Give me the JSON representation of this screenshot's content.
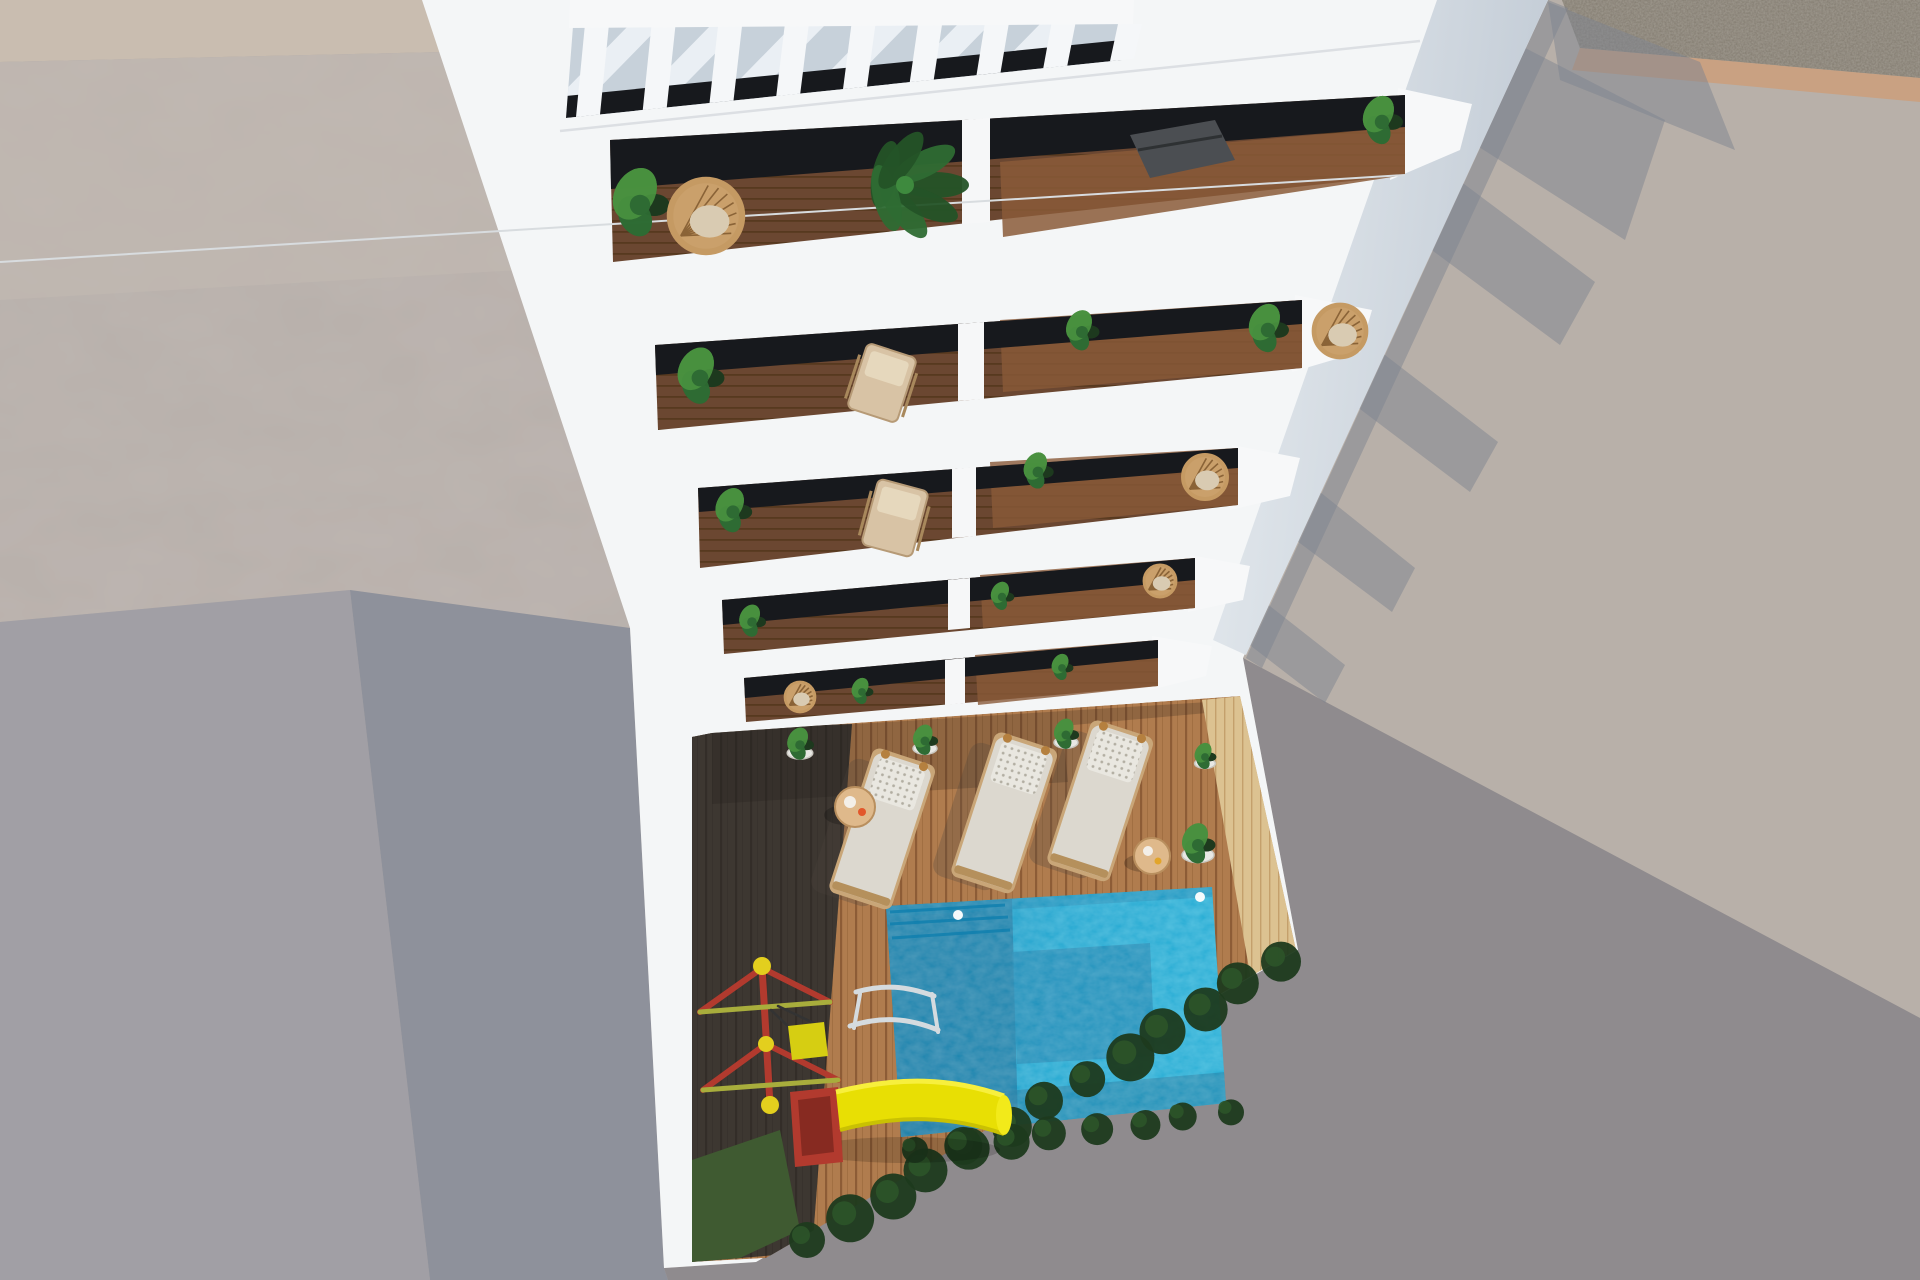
{
  "scene": {
    "title": "aerial-render-apartment-building-pool-courtyard",
    "description": "Top-down 3D architectural render: white apartment tower with pergola roof and five balcony rows over a courtyard with swimming pool, wood deck, sun loungers and children's playground",
    "colors": {
      "ground_base": "#b4aba4",
      "ground_lit": "#b8b0a9",
      "ground_shadow": "#8f8b8e",
      "concrete_left": "#b8b0ab",
      "concrete_light": "#c2bab3",
      "tan_strip": "#c9bdb0",
      "plane_a": "#a19fa5",
      "plane_b": "#8e919b",
      "gravel": "#a09a90",
      "gravel_border": "#c9a182",
      "building": "#f4f6f7",
      "building_face": "#cfd8e0",
      "pergola_floor": "#c7d1da",
      "glass": "#17191d",
      "balcony_wood": "#6b4731",
      "balcony_wood_lit": "#8a5a38",
      "deck_lit": "#b07c4e",
      "deck_line": "#8d5c36",
      "deck_shadow": "#2e2a26",
      "pool_bright": "#1aa6d0",
      "pool_mid": "#1187b3",
      "pool_dark": "#0b5c86",
      "pool_deep": "#0a5278",
      "sand": "#dcc291",
      "sand_line": "#c4a06c",
      "lounger": "#dcd8cf",
      "pillow": "#edece6",
      "knob": "#b5803f",
      "slide_yellow": "#e8df04",
      "play_red": "#b23a2e",
      "play_red_dark": "#872a21",
      "cap_yellow": "#e3cf1e",
      "bar_green": "#a8ad3c",
      "plant_dark": "#1d3a1e",
      "plant_mid": "#2e6b33",
      "plant_light": "#49903f",
      "wicker": "#c59a63",
      "wicker_dark": "#8a6337",
      "grass": "#3f5a31",
      "wall_inner_dark": "#5f5850",
      "ladder": "#d5dbdf",
      "spike_shadow": "#7d8390",
      "chair_beige": "#d8c3a5",
      "dark_lounger": "#4b4e52",
      "table_wood": "#dfb98b"
    },
    "counts": {
      "balcony_rows": 5,
      "pergola_slats": 8,
      "sun_loungers": 3,
      "side_tables": 2,
      "potted_plants": 5,
      "pool_lights": 2
    },
    "pergola": {
      "slat_count": 8,
      "stripe_count": 6
    },
    "loungers": [
      {
        "x": 902,
        "y": 768,
        "angle": 18
      },
      {
        "x": 1024,
        "y": 752,
        "angle": 18
      },
      {
        "x": 1120,
        "y": 740,
        "angle": 18
      }
    ],
    "pots": [
      {
        "x": 800,
        "y": 745,
        "r": 16
      },
      {
        "x": 925,
        "y": 741,
        "r": 15
      },
      {
        "x": 1066,
        "y": 735,
        "r": 15
      },
      {
        "x": 1205,
        "y": 757,
        "r": 13
      },
      {
        "x": 1198,
        "y": 845,
        "r": 20
      }
    ],
    "shadow_spikes": [
      "1500,35 1665,120 1625,240 1468,140",
      "1548,2 1700,62 1735,150 1560,80",
      "1452,175 1595,282 1560,345 1425,245",
      "1372,345 1498,442 1470,492 1348,400",
      "1305,480 1415,568 1392,612 1285,532",
      "1252,592 1345,665 1325,703 1238,636",
      "1548,0 1568,8 1262,668 1246,658"
    ],
    "shrub_strip": {
      "x1": 812,
      "y1": 1242,
      "x2": 1282,
      "y2": 962,
      "n": 13
    },
    "shrub_strip2": {
      "x1": 920,
      "y1": 1152,
      "x2": 1230,
      "y2": 1112,
      "n": 8
    },
    "balcony_plants": [
      [
        640,
        205,
        34
      ],
      [
        1382,
        122,
        24
      ],
      [
        700,
        378,
        28
      ],
      [
        1082,
        332,
        20
      ],
      [
        733,
        512,
        22
      ],
      [
        1038,
        472,
        18
      ],
      [
        752,
        622,
        16
      ],
      [
        1002,
        597,
        14
      ],
      [
        862,
        692,
        13
      ],
      [
        1062,
        668,
        13
      ],
      [
        1268,
        330,
        24
      ]
    ],
    "wicker_chairs": [
      [
        706,
        216,
        36
      ],
      [
        1340,
        331,
        26
      ],
      [
        1205,
        477,
        22
      ],
      [
        1160,
        581,
        16
      ],
      [
        800,
        697,
        15
      ]
    ],
    "deck_chairs": [
      [
        882,
        383,
        18
      ],
      [
        895,
        518,
        15
      ]
    ]
  }
}
